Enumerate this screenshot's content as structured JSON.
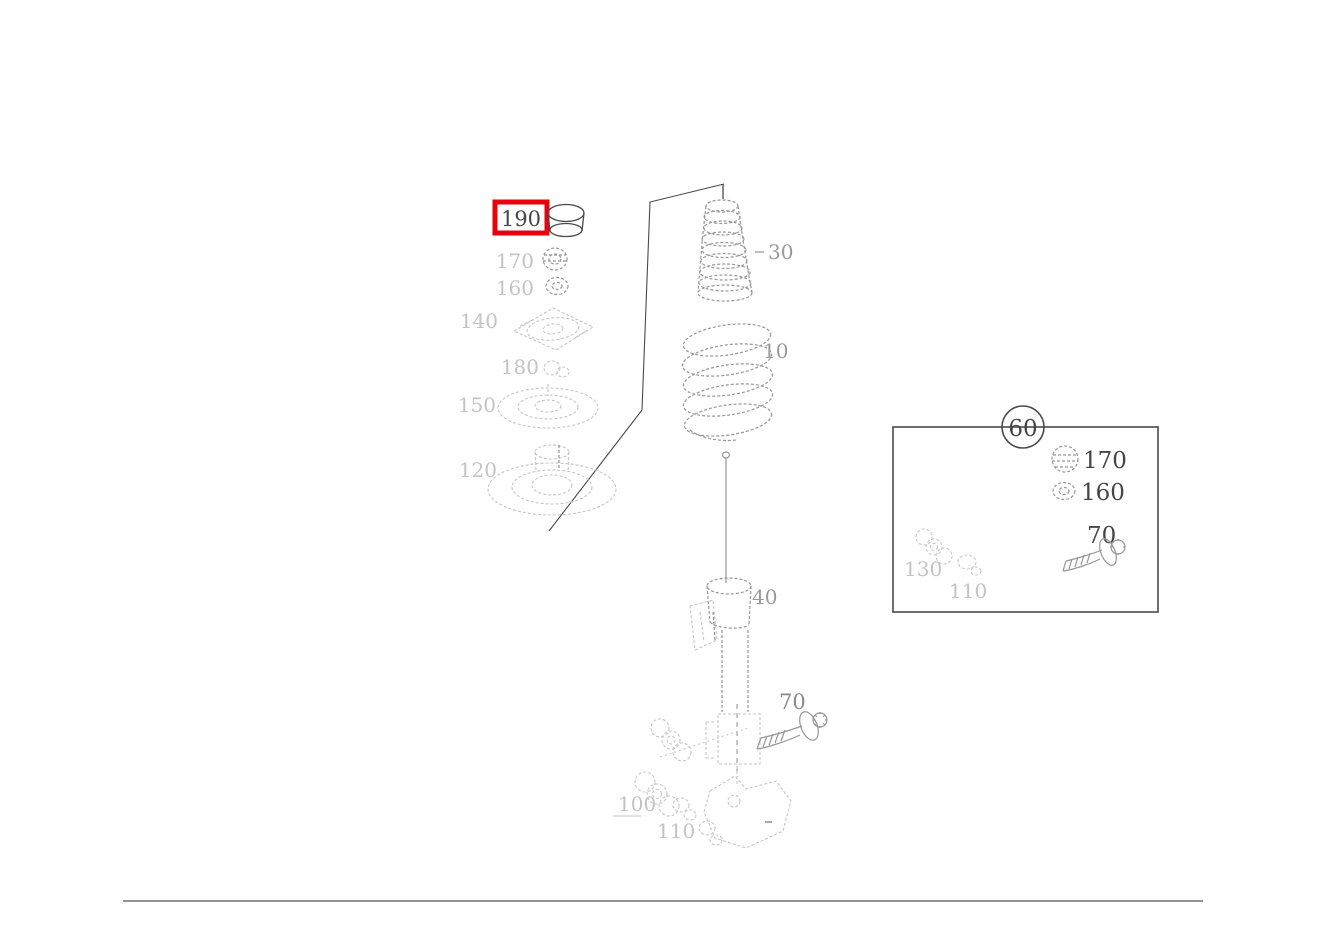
{
  "diagram": {
    "description": "exploded parts diagram of a front suspension spring strut",
    "colors": {
      "highlight_red": "#e8000c",
      "ink": "#4a4a4a",
      "mid_gray": "#979797",
      "faint_gray": "#c6c6c6",
      "background": "#ffffff"
    },
    "selected_part": "190",
    "labels": {
      "cap": "190",
      "top_nut": "170",
      "top_washer": "160",
      "support_mount": "140",
      "ring": "180",
      "upper_spring_seat": "150",
      "lower_spring_seat": "120",
      "bump_stop": "30",
      "coil_spring": "10",
      "shock_absorber": "40",
      "clamp_bolt": "70",
      "nut_set": "100",
      "washer_set": "110"
    },
    "inset": {
      "kit_number": "60",
      "items": [
        {
          "icon": "nut-icon",
          "label": "170"
        },
        {
          "icon": "washer-icon",
          "label": "160"
        },
        {
          "icon": "bolt-icon",
          "label": "70"
        },
        {
          "icon": "nut-stack-icon",
          "label": "130"
        },
        {
          "icon": "washer-icon",
          "label": "110"
        }
      ]
    },
    "icons": [
      "cap-icon",
      "nut-icon",
      "washer-icon",
      "mount-icon",
      "spring-seat-icon",
      "bump-stop-icon",
      "coil-spring-icon",
      "shock-absorber-icon",
      "bolt-icon",
      "nut-stack-icon",
      "knuckle-icon"
    ]
  }
}
